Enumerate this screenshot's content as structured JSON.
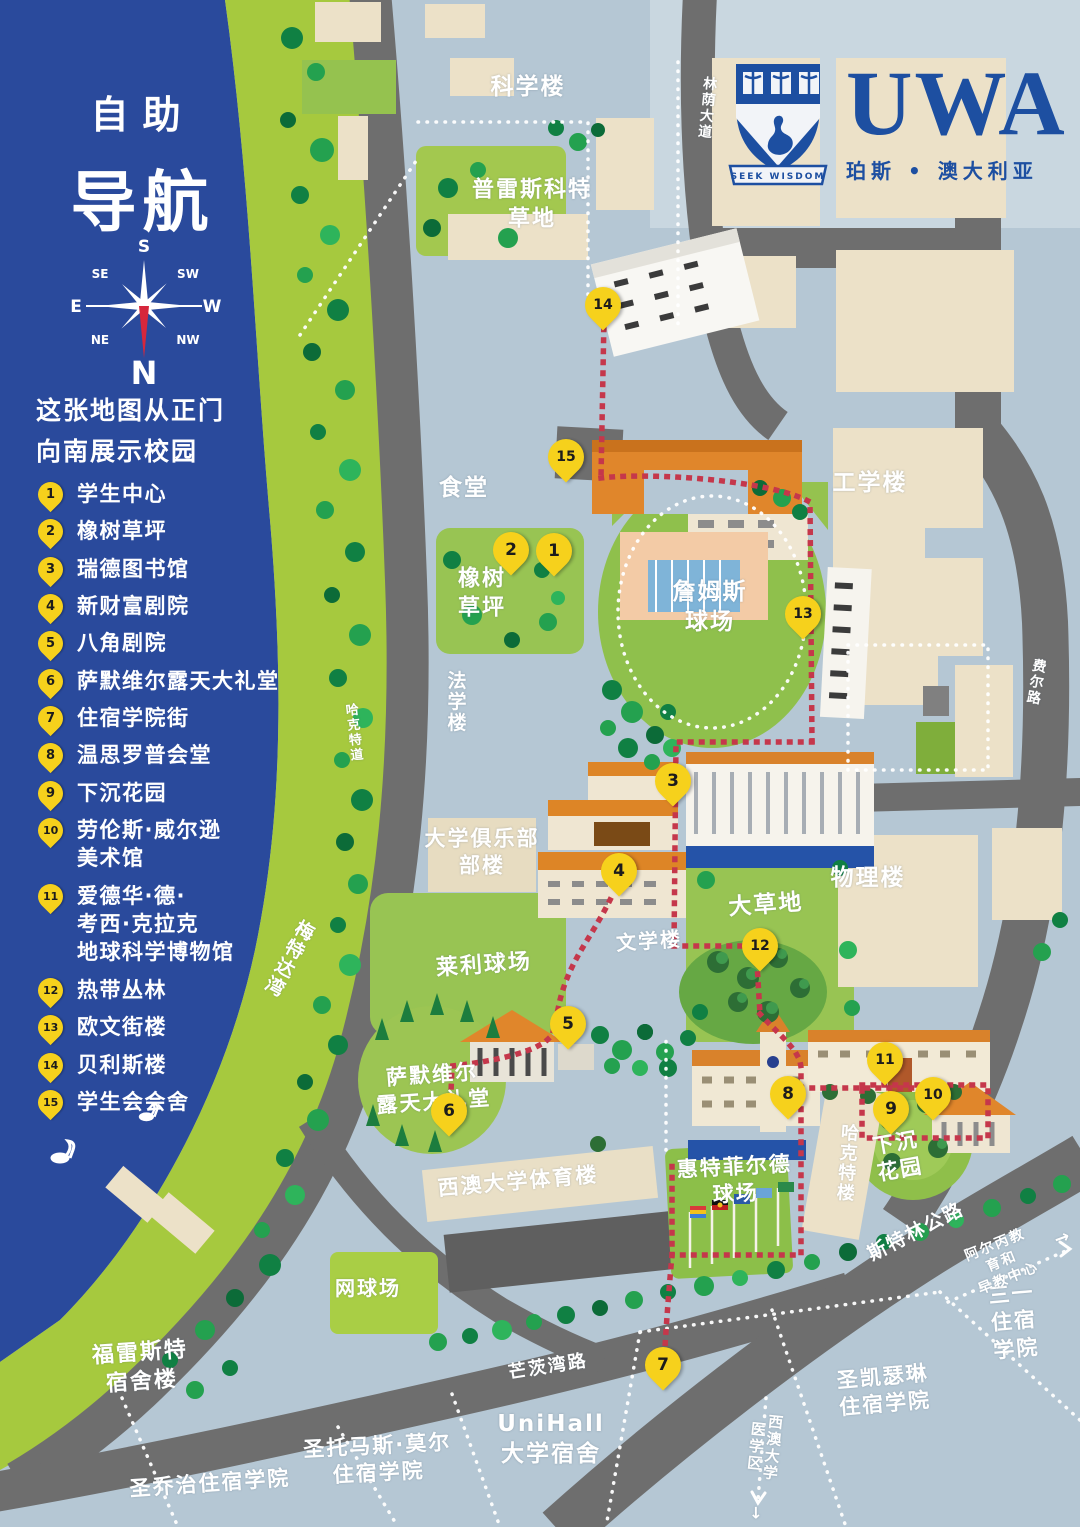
{
  "title": {
    "line1": "自助",
    "line2": "导航"
  },
  "note": "这张地图从正门\n向南展示校园",
  "compass": {
    "n": "N",
    "s": "S",
    "e": "E",
    "w": "W",
    "se": "SE",
    "sw": "SW",
    "ne": "NE",
    "nw": "NW"
  },
  "logo": {
    "acronym": "UWA",
    "motto": "SEEK WISDOM",
    "subtitle": "珀斯 • 澳大利亚"
  },
  "colors": {
    "water": "#2a4a9c",
    "park": "#a6c93e",
    "ground": "#b5c7d4",
    "road": "#6e6e6e",
    "lawn": "#95c24f",
    "building": "#ece1c8",
    "roof_orange": "#dd8526",
    "route_red": "#c5374b",
    "pin_yellow": "#f6d11c",
    "brand_navy": "#1d4fa1"
  },
  "legend": [
    {
      "n": "1",
      "label": "学生中心"
    },
    {
      "n": "2",
      "label": "橡树草坪"
    },
    {
      "n": "3",
      "label": "瑞德图书馆"
    },
    {
      "n": "4",
      "label": "新财富剧院"
    },
    {
      "n": "5",
      "label": "八角剧院"
    },
    {
      "n": "6",
      "label": "萨默维尔露天大礼堂"
    },
    {
      "n": "7",
      "label": "住宿学院街"
    },
    {
      "n": "8",
      "label": "温思罗普会堂"
    },
    {
      "n": "9",
      "label": "下沉花园"
    },
    {
      "n": "10",
      "label": "劳伦斯·威尔逊\n美术馆"
    },
    {
      "n": "11",
      "label": "爱德华·德·\n考西·克拉克\n地球科学博物馆"
    },
    {
      "n": "12",
      "label": "热带丛林"
    },
    {
      "n": "13",
      "label": "欧文街楼"
    },
    {
      "n": "14",
      "label": "贝利斯楼"
    },
    {
      "n": "15",
      "label": "学生会会舍"
    }
  ],
  "pins": [
    {
      "n": "1",
      "x": 554,
      "y": 577
    },
    {
      "n": "2",
      "x": 511,
      "y": 576
    },
    {
      "n": "3",
      "x": 673,
      "y": 807
    },
    {
      "n": "4",
      "x": 619,
      "y": 897
    },
    {
      "n": "5",
      "x": 568,
      "y": 1050
    },
    {
      "n": "6",
      "x": 449,
      "y": 1137
    },
    {
      "n": "7",
      "x": 663,
      "y": 1391
    },
    {
      "n": "8",
      "x": 788,
      "y": 1120
    },
    {
      "n": "9",
      "x": 891,
      "y": 1135
    },
    {
      "n": "10",
      "x": 933,
      "y": 1121
    },
    {
      "n": "11",
      "x": 885,
      "y": 1086
    },
    {
      "n": "12",
      "x": 760,
      "y": 972
    },
    {
      "n": "13",
      "x": 803,
      "y": 640
    },
    {
      "n": "14",
      "x": 603,
      "y": 331
    },
    {
      "n": "15",
      "x": 566,
      "y": 483
    }
  ],
  "map_labels": [
    {
      "t": "科学楼",
      "x": 528,
      "y": 88,
      "fs": 23
    },
    {
      "t": "普雷斯科特\n草地",
      "x": 532,
      "y": 205,
      "fs": 22
    },
    {
      "t": "林荫大道",
      "x": 706,
      "y": 108,
      "fs": 14,
      "vert": true,
      "rot": 6
    },
    {
      "t": "食堂",
      "x": 464,
      "y": 489,
      "fs": 23
    },
    {
      "t": "橡树\n草坪",
      "x": 482,
      "y": 594,
      "fs": 22
    },
    {
      "t": "法学楼",
      "x": 455,
      "y": 702,
      "fs": 19,
      "vert": true
    },
    {
      "t": "詹姆斯\n球场",
      "x": 710,
      "y": 608,
      "fs": 23
    },
    {
      "t": "工学楼",
      "x": 870,
      "y": 484,
      "fs": 23
    },
    {
      "t": "费尔路",
      "x": 1035,
      "y": 682,
      "fs": 14,
      "vert": true,
      "rot": 10
    },
    {
      "t": "哈克特道",
      "x": 352,
      "y": 733,
      "fs": 13,
      "vert": true,
      "rot": -6
    },
    {
      "t": "梅特达湾",
      "x": 288,
      "y": 958,
      "fs": 19,
      "vert": true,
      "rot": 28
    },
    {
      "t": "大学俱乐部\n部楼",
      "x": 482,
      "y": 853,
      "fs": 21
    },
    {
      "t": "文学楼",
      "x": 649,
      "y": 941,
      "fs": 20,
      "rot": -4
    },
    {
      "t": "大草地",
      "x": 766,
      "y": 906,
      "fs": 23,
      "rot": -4
    },
    {
      "t": "物理楼",
      "x": 868,
      "y": 879,
      "fs": 23
    },
    {
      "t": "莱利球场",
      "x": 484,
      "y": 966,
      "fs": 22,
      "rot": -4
    },
    {
      "t": "萨默维尔\n露天大礼堂",
      "x": 433,
      "y": 1089,
      "fs": 21,
      "rot": -4
    },
    {
      "t": "西澳大学体育楼",
      "x": 518,
      "y": 1182,
      "fs": 21,
      "rot": -5
    },
    {
      "t": "哈克特楼",
      "x": 846,
      "y": 1163,
      "fs": 18,
      "vert": true,
      "rot": 4
    },
    {
      "t": "惠特菲尔德\n球场",
      "x": 735,
      "y": 1181,
      "fs": 21,
      "rot": -3
    },
    {
      "t": "下沉\n花园",
      "x": 898,
      "y": 1157,
      "fs": 21,
      "rot": -10
    },
    {
      "t": "网球场",
      "x": 368,
      "y": 1288,
      "fs": 20
    },
    {
      "t": "福雷斯特\n宿舍楼",
      "x": 141,
      "y": 1368,
      "fs": 22,
      "rot": -4
    },
    {
      "t": "圣乔治住宿学院",
      "x": 210,
      "y": 1484,
      "fs": 21,
      "rot": -4
    },
    {
      "t": "圣托马斯·莫尔\n住宿学院",
      "x": 378,
      "y": 1460,
      "fs": 21,
      "rot": -3
    },
    {
      "t": "UniHall\n大学宿舍",
      "x": 551,
      "y": 1440,
      "fs": 23
    },
    {
      "t": "圣凯瑟琳\n住宿学院",
      "x": 884,
      "y": 1391,
      "fs": 21,
      "rot": -5
    },
    {
      "t": "三一住宿\n学院",
      "x": 1014,
      "y": 1322,
      "fs": 21,
      "rot": -5
    },
    {
      "t": "斯特林公路",
      "x": 916,
      "y": 1232,
      "fs": 19,
      "rot": -27
    },
    {
      "t": "阿尔丙教育和\n早教中心",
      "x": 1002,
      "y": 1262,
      "fs": 14,
      "rot": -22
    },
    {
      "t": "→",
      "x": 1063,
      "y": 1238,
      "fs": 18,
      "rot": -20
    },
    {
      "t": "芒茨湾路",
      "x": 548,
      "y": 1367,
      "fs": 18,
      "rot": -9
    },
    {
      "t": "西澳大学医学区",
      "x": 764,
      "y": 1447,
      "fs": 15,
      "vert": true,
      "rot": 6
    },
    {
      "t": "↓",
      "x": 757,
      "y": 1514,
      "fs": 16
    }
  ]
}
